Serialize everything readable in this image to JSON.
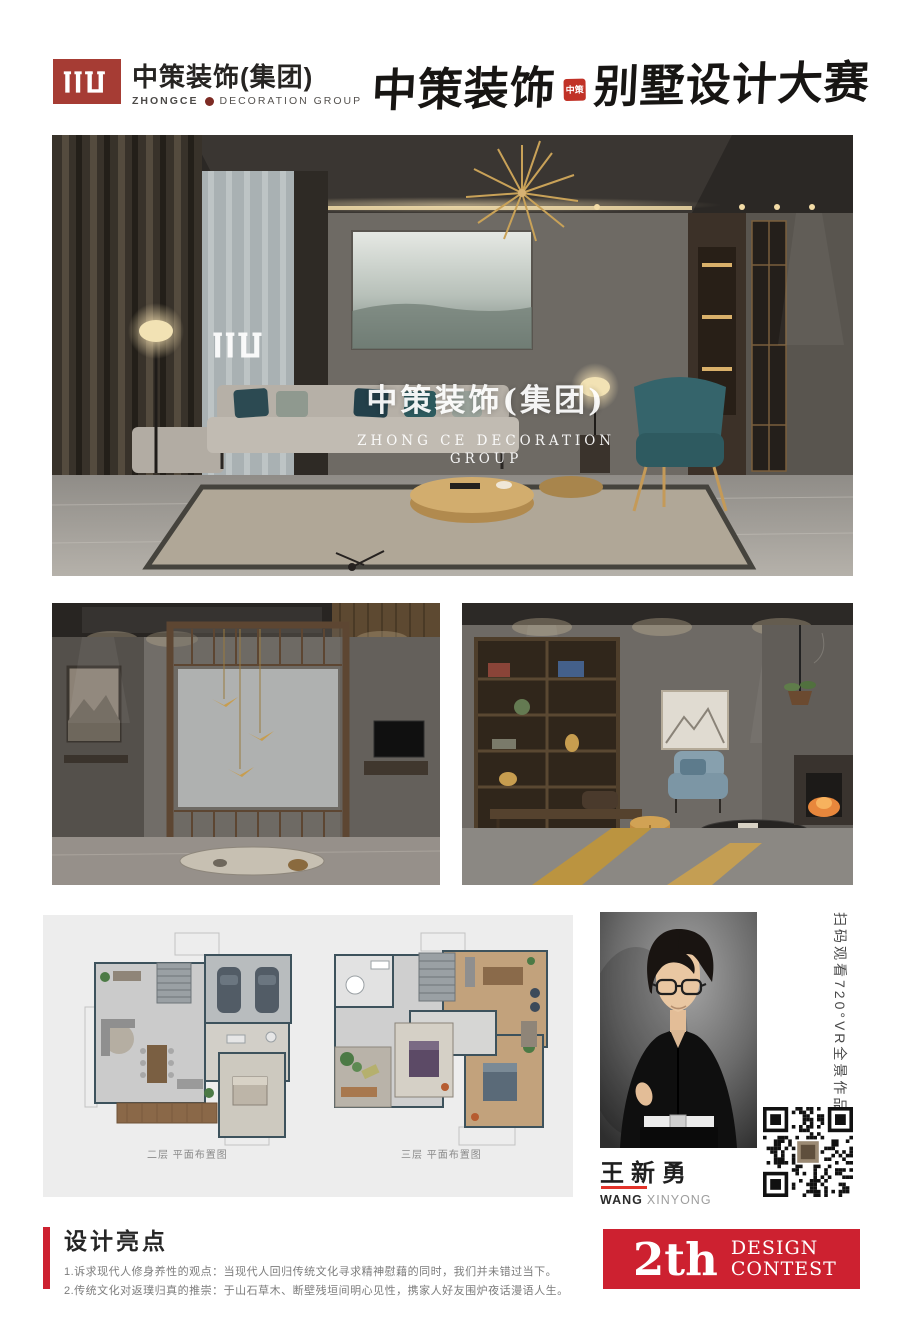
{
  "header": {
    "brand_cn": "中策装饰(集团)",
    "brand_en_bold": "ZHONGCE",
    "brand_en_rest": "DECORATION GROUP",
    "title_cn_left": "中策装饰",
    "seal_text": "中策",
    "title_cn_right": "别墅设计大赛"
  },
  "hero": {
    "watermark_cn": "中策装饰(集团)",
    "watermark_en_1": "ZHONG CE DECORATION",
    "watermark_en_2": "GROUP"
  },
  "floorplans": {
    "plans": [
      {
        "caption": "二层 平面布置图"
      },
      {
        "caption": "三层 平面布置图"
      }
    ]
  },
  "designer": {
    "name_cn": "王新勇",
    "name_en_primary": "WANG",
    "name_en_secondary": "XINYONG",
    "vr_caption": "扫码观看720°VR全景作品"
  },
  "footer": {
    "section_title": "设计亮点",
    "points": [
      "1.诉求现代人修身养性的观点：当现代人回归传统文化寻求精神慰藉的同时，我们并未错过当下。",
      "2.传统文化对返璞归真的推崇：于山石草木、断壁残垣间明心见性，携家人好友围炉夜话漫语人生。"
    ],
    "badge": {
      "number": "2th",
      "line1": "DESIGN",
      "line2": "CONTEST"
    }
  },
  "colors": {
    "brand_red_dark": "#a63c34",
    "accent_red": "#cd2130",
    "panel_gray": "#ededed"
  }
}
